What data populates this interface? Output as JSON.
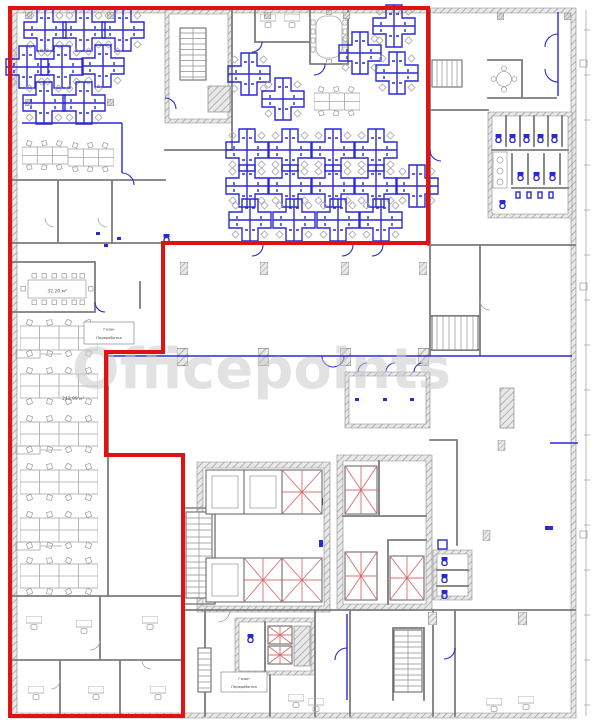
{
  "watermark": {
    "text": "Officepoints"
  },
  "labels": {
    "area_meeting_room": "32,20 м²",
    "area_open_space": "243,99 м²",
    "room_box_top": {
      "line1": "Газон",
      "line2": "Переработка"
    },
    "room_box_bottom": {
      "line1": "Газон",
      "line2": "Переработка"
    }
  },
  "colors": {
    "lease_boundary": "#e11212",
    "furniture": "#2a2ad2",
    "walls": "#7c7c7c",
    "light_furniture": "#a6a6a6",
    "elevator_marks": "#d97070",
    "watermark": "#cccccc",
    "background": "#ffffff"
  }
}
